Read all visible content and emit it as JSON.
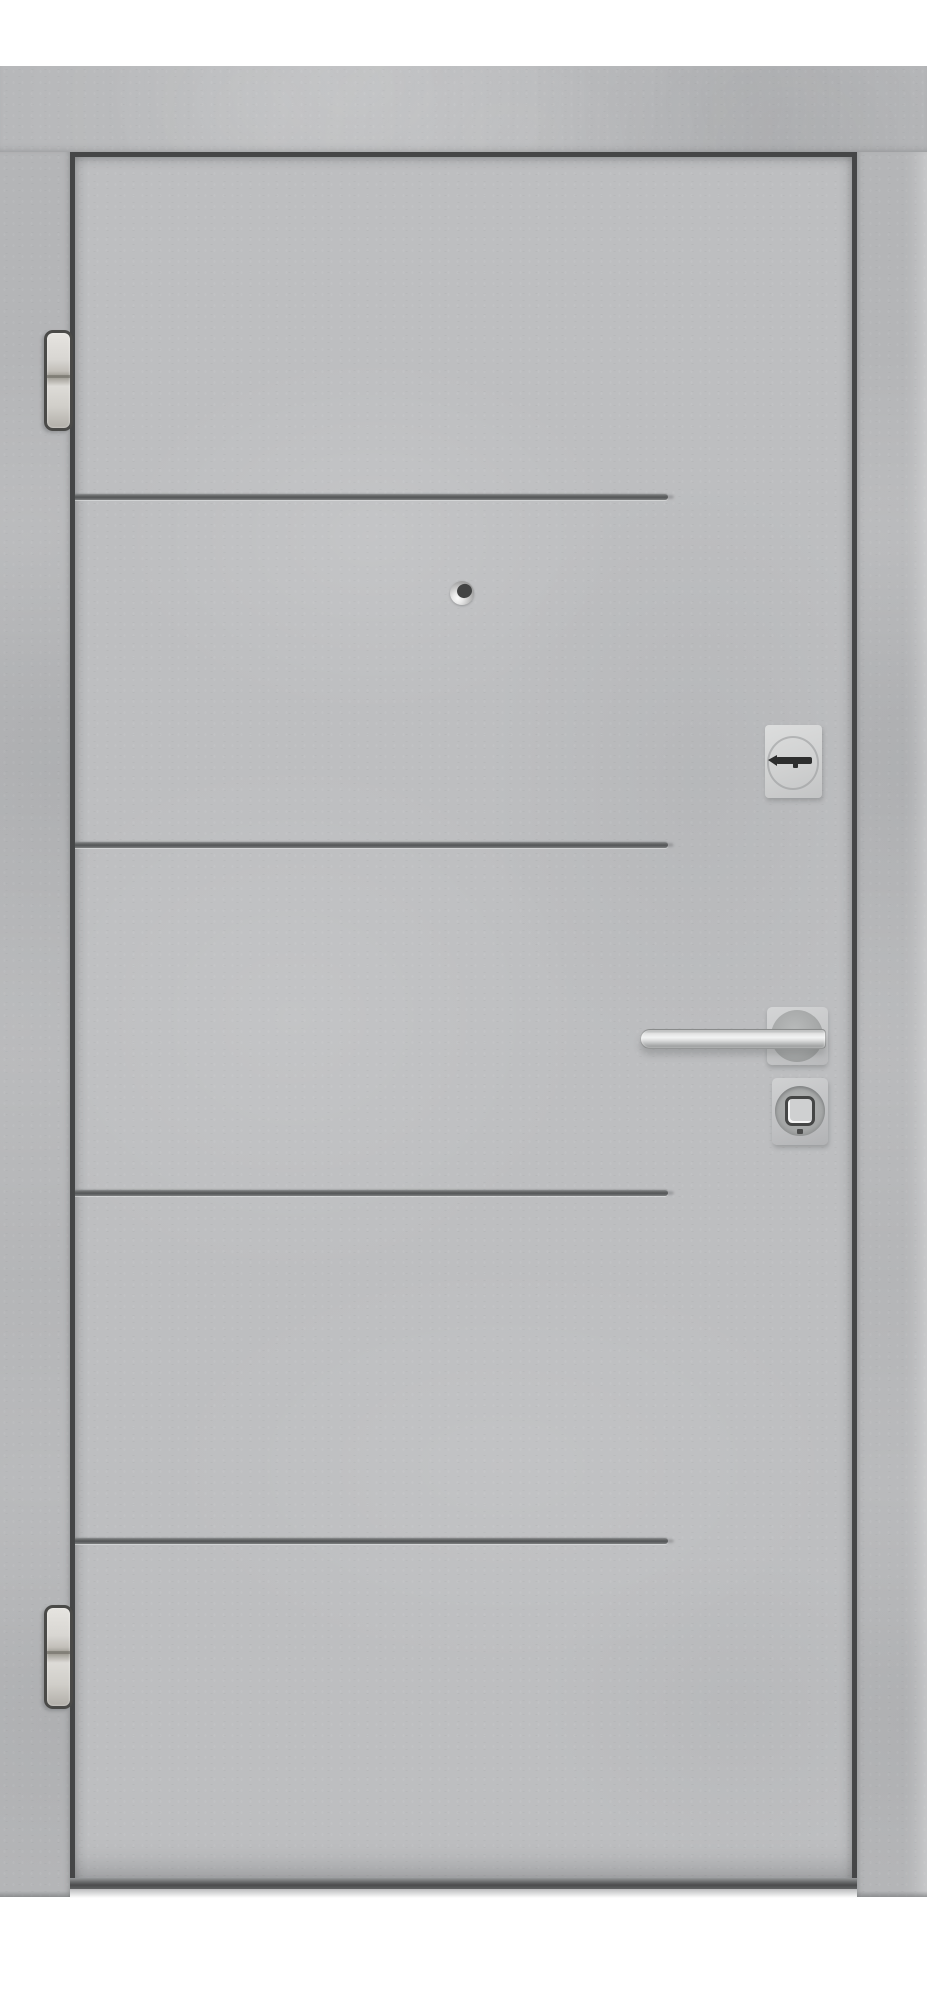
{
  "meta": {
    "type": "product-photo",
    "subject": "Entry door with gray concrete-look finish, four horizontal grooves, chrome lever handle, lock cylinder, thumbturn, peephole and two hinges on white background"
  },
  "palette": {
    "background": "#ffffff",
    "concrete_base": "#bdbec0",
    "concrete_frame": "#b4b5b7",
    "concrete_header": "#b6b7b9",
    "gap_dark": "#454647",
    "groove_dark": "#565859",
    "bottom_edge_dark": "#4b4c4d",
    "metal_bright": "#f2f3f3",
    "metal_shadow": "#8f9191",
    "hinge_outline": "#4a4a48",
    "slot_black": "#2d2e2e",
    "lens_dark": "#434444"
  },
  "parts": {
    "frame_header": {
      "label": "door frame header"
    },
    "frame_left_jamb": {
      "label": "door frame left jamb"
    },
    "frame_right_jamb": {
      "label": "door frame right jamb"
    },
    "leaf": {
      "label": "door leaf with concrete texture",
      "groove_count": 4
    },
    "hinge_top": {
      "label": "top hinge"
    },
    "hinge_bottom": {
      "label": "bottom hinge"
    },
    "peephole": {
      "label": "peephole viewer"
    },
    "cylinder": {
      "label": "lock cylinder escutcheon with key slot"
    },
    "handle": {
      "label": "chrome lever handle on square rosette"
    },
    "thumbturn": {
      "label": "deadbolt thumbturn escutcheon"
    }
  }
}
